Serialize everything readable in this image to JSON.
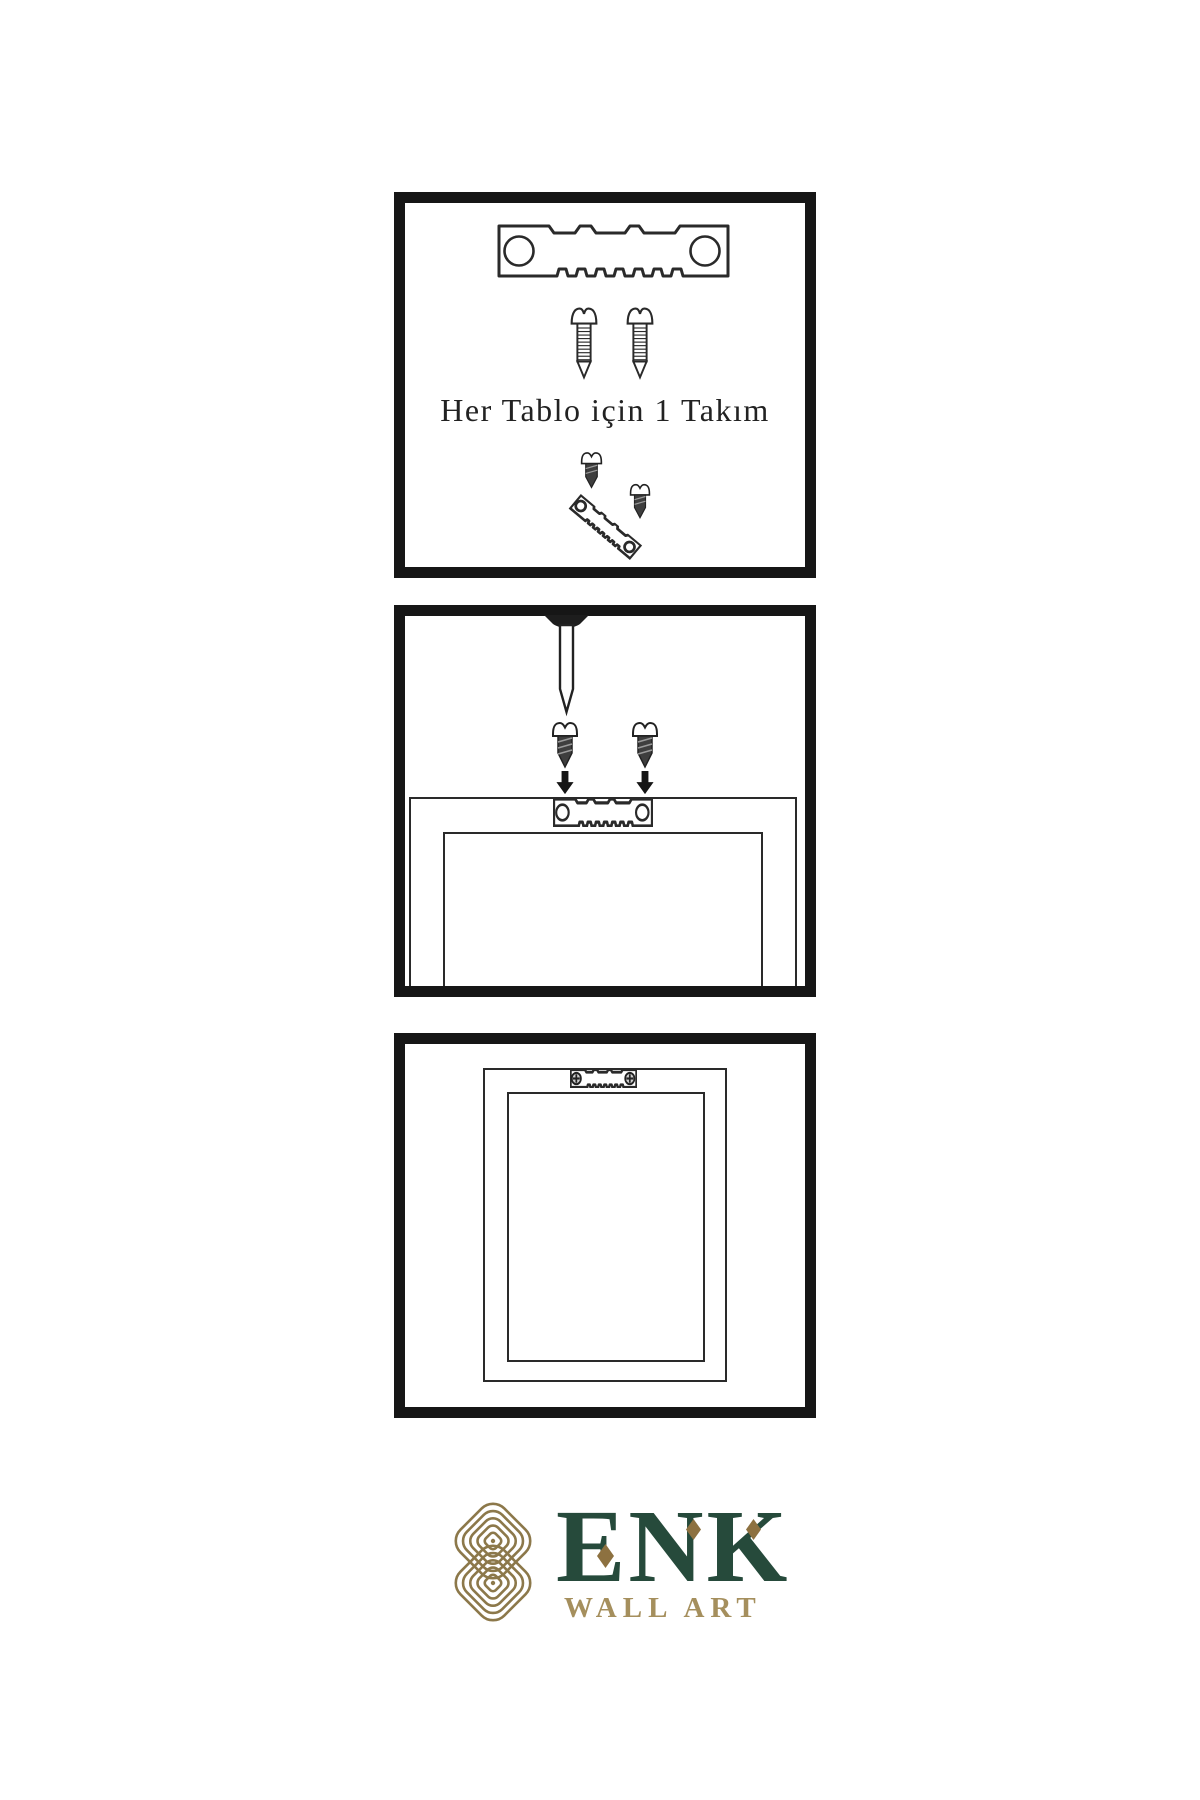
{
  "document": {
    "type": "wall-art-hanging-kit-instructions",
    "language": "tr"
  },
  "panels": {
    "step1": {
      "caption": "Her Tablo için 1 Takım",
      "contents": [
        "sawtooth-hanger",
        "screw",
        "screw",
        "screw-into-hanger-assembly"
      ]
    },
    "step2": {
      "contents": [
        "wall-nail",
        "dark-screw",
        "dark-screw",
        "down-arrow",
        "down-arrow",
        "frame-back",
        "sawtooth-hanger"
      ]
    },
    "step3": {
      "contents": [
        "hung-frame-back",
        "mounted-sawtooth-hanger-with-screws"
      ]
    }
  },
  "logo": {
    "brand": "ENK",
    "subtitle": "WALL ART"
  },
  "style": {
    "colors": {
      "background": "#ffffff",
      "panel-border": "#161616",
      "line": "#2a2a2a",
      "ink-dark": "#1d1d1d",
      "screw-fill": "#3e3e3e",
      "brand-green": "#264a3b",
      "logo-gold": "#8c784a",
      "subtitle-gold": "#a58f5d",
      "diamond-gold": "#8d7140"
    }
  }
}
